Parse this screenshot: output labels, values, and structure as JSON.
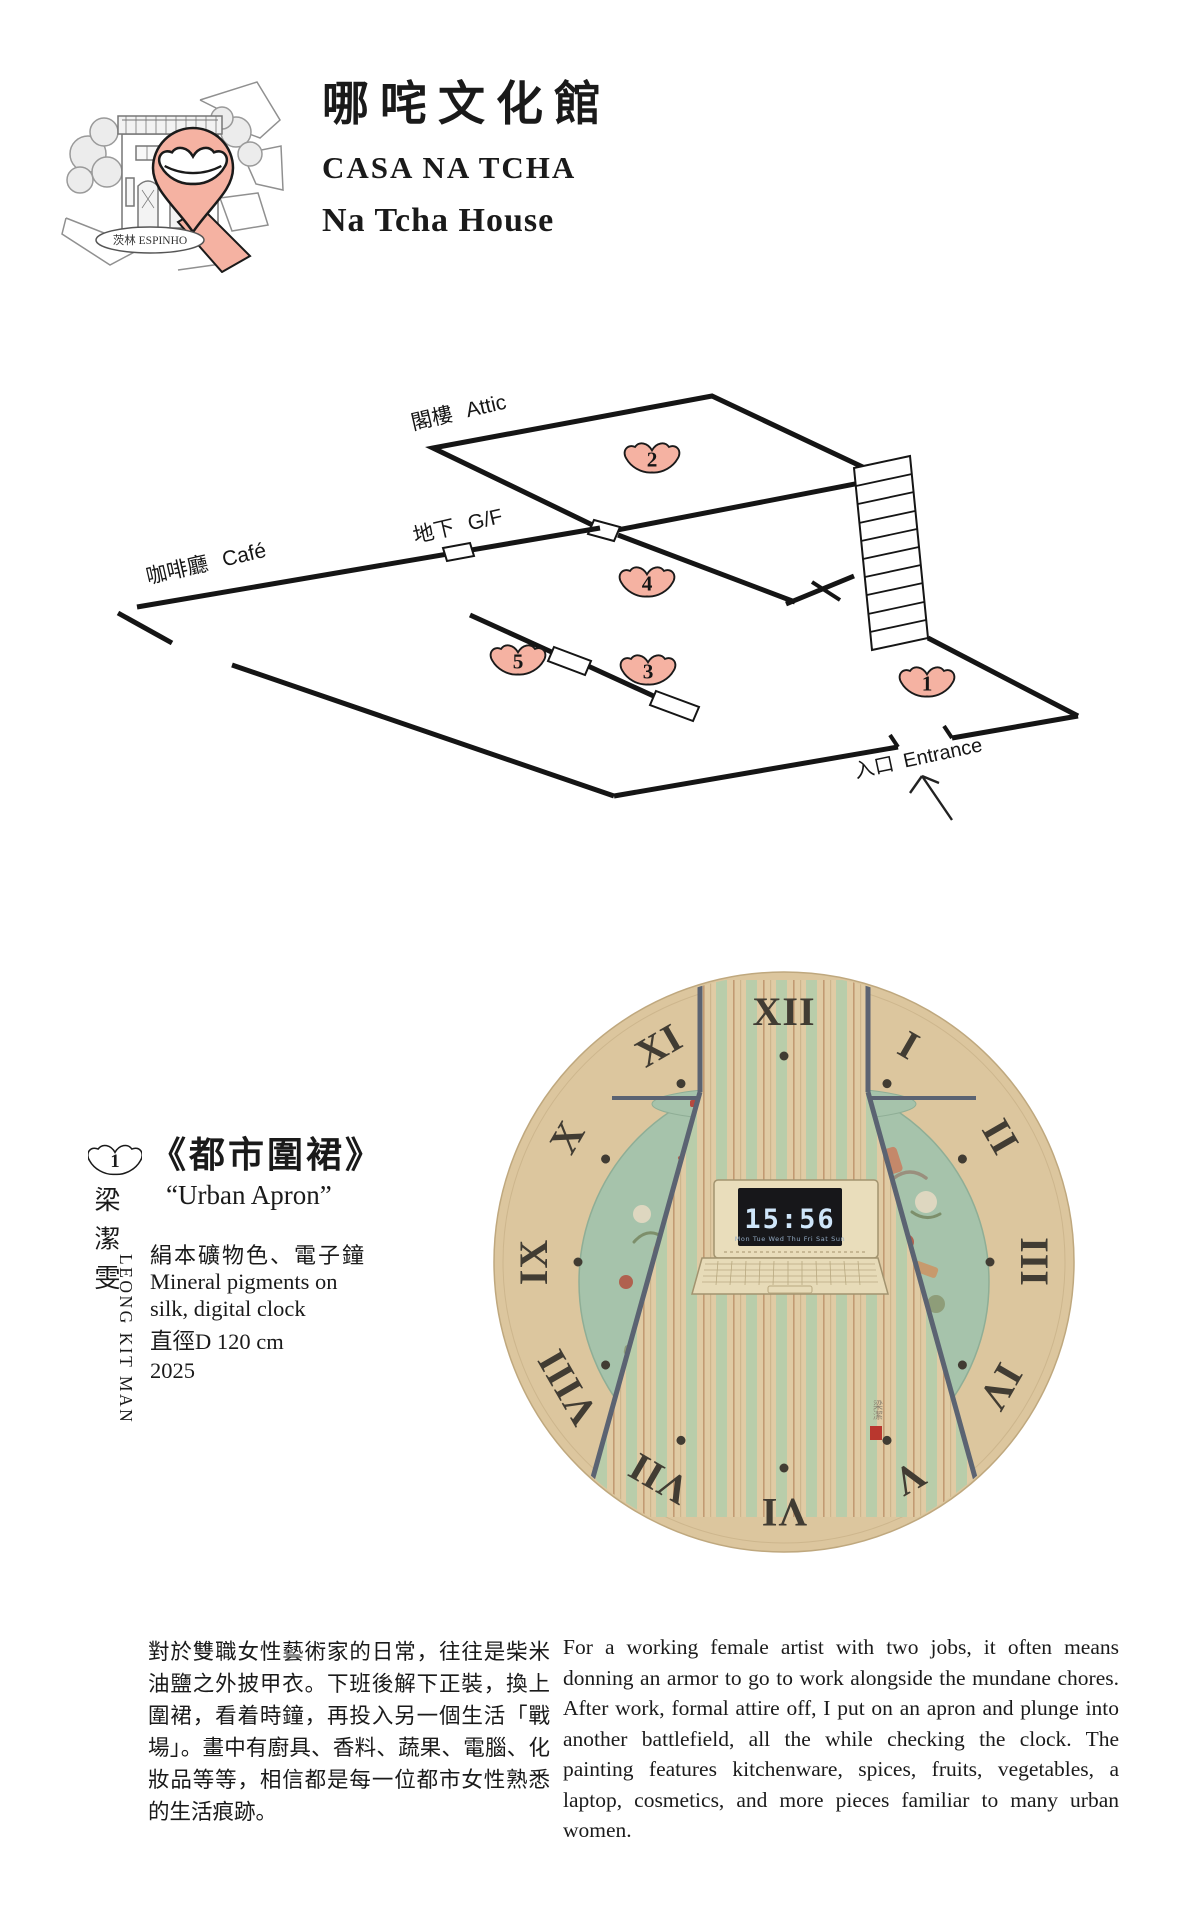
{
  "header": {
    "title_zh": "哪咤文化館",
    "title_pt": "CASA NA TCHA",
    "title_en": "Na Tcha House",
    "logo_label": "茨林 ESPINHO"
  },
  "floor_plan": {
    "attic_zh": "閣樓",
    "attic_en": "Attic",
    "gf_zh": "地下",
    "gf_en": "G/F",
    "cafe_zh": "咖啡廳",
    "cafe_en": "Café",
    "entrance_zh": "入口",
    "entrance_en": "Entrance",
    "markers": [
      "1",
      "2",
      "3",
      "4",
      "5"
    ]
  },
  "artwork": {
    "number": "1",
    "artist_zh": "梁潔雯",
    "artist_en": "LEONG KIT MAN",
    "title_zh": "《都市圍裙》",
    "title_en": "“Urban Apron”",
    "medium_zh": "絹本礦物色、電子鐘",
    "medium_en": "Mineral pigments on silk, digital clock",
    "dimensions": "直徑D 120 cm",
    "year": "2025",
    "clock_time": "15:56",
    "clock_days": "Mon Tue Wed Thu Fri Sat Sun",
    "roman_numerals": [
      "XII",
      "I",
      "II",
      "III",
      "IV",
      "V",
      "VI",
      "VII",
      "VIII",
      "IX",
      "X",
      "XI"
    ],
    "signature_zh": "梁潔",
    "colors": {
      "face_tan": "#dcc69e",
      "fabric_green": "#a6c3ab",
      "stripe_green": "#b9cdaa",
      "slate": "#5b6372",
      "marker_pink": "#f5b2a2",
      "digit_blue": "#cfe6fa",
      "seal_red": "#b9372e"
    }
  },
  "description": {
    "zh": "對於雙職女性藝術家的日常，往往是柴米油鹽之外披甲衣。下班後解下正裝，換上圍裙，看着時鐘，再投入另一個生活「戰場」。畫中有廚具、香料、蔬果、電腦、化妝品等等，相信都是每一位都市女性熟悉的生活痕跡。",
    "en": "For a working female artist with two jobs, it often means donning an armor to go to work alongside the mundane chores. After work, formal attire off, I put on an apron and plunge into another battlefield, all the while checking the clock. The painting features kitchenware, spices, fruits, vegetables, a laptop, cosmetics, and more pieces familiar to many urban women."
  }
}
